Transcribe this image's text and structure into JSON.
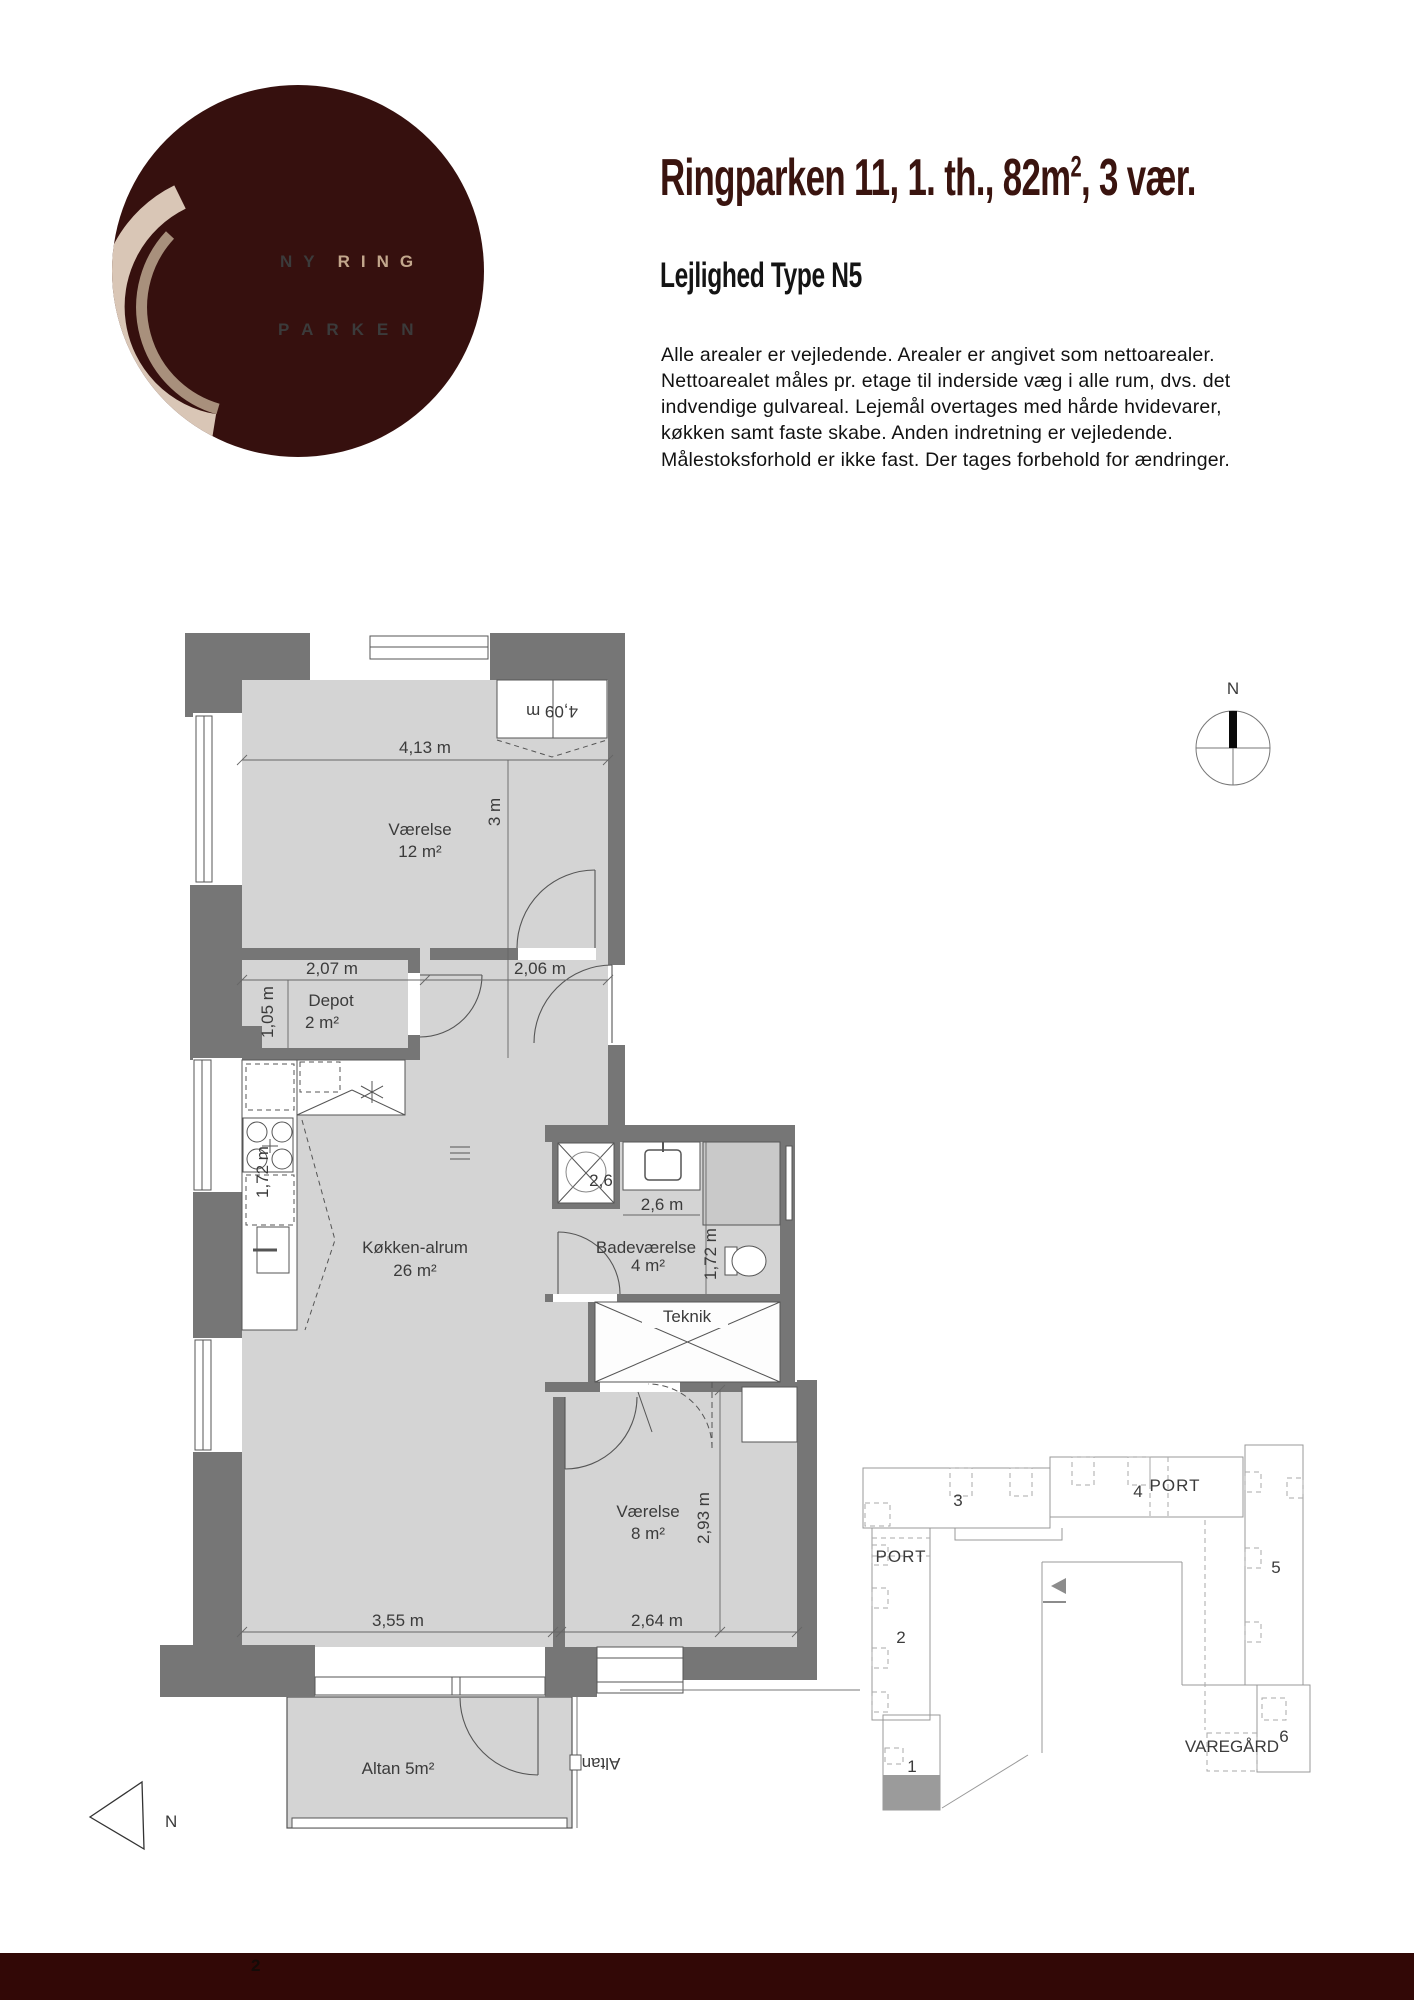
{
  "logo": {
    "line1_word1": "NY",
    "line1_word2": "RING",
    "line2": "PARKEN",
    "bg_color": "#36100e",
    "ring_color": "#d9c6b6",
    "ring_accent_color": "#a8907c",
    "accent_text_color": "#c3a78c"
  },
  "header": {
    "title_prefix": "Ringparken 11, 1. th., 82m",
    "title_sup": "2",
    "title_suffix": ", 3 vær.",
    "subtitle": "Lejlighed Type N5",
    "title_color": "#3a140f"
  },
  "description": "Alle arealer er vejledende. Arealer er angivet som nettoarealer. Nettoarealet måles pr. etage til inderside væg i alle rum, dvs. det indvendige gulvareal. Lejemål overtages med hårde hvidevarer, køkken samt faste skabe. Anden indretning er vejledende. Målestoksforhold er ikke fast. Der tages forbehold for ændringer.",
  "compass": {
    "north_label": "N"
  },
  "plan": {
    "colors": {
      "wall": "#767676",
      "floor": "#d4d4d4",
      "line": "#555555"
    },
    "rooms": {
      "vaerelse12": {
        "name": "Værelse",
        "area": "12 m²"
      },
      "depot": {
        "name": "Depot",
        "area": "2 m²"
      },
      "koekken": {
        "name": "Køkken-alrum",
        "area": "26 m²"
      },
      "bad": {
        "name": "Badeværelse",
        "area": "4 m²"
      },
      "teknik": {
        "name": "Teknik"
      },
      "vaerelse8": {
        "name": "Værelse",
        "area": "8 m²"
      },
      "altan": {
        "label": "Altan 5m²"
      },
      "neighbor_altan": {
        "label": "Altan"
      }
    },
    "dims": {
      "top_width": "4,13 m",
      "room1_height": "3 m",
      "closet": "4,09 m",
      "depot_width": "2,07 m",
      "hall_width": "2,06 m",
      "depot_height": "1,05 m",
      "kitchen_run": "1,72 m",
      "shower": "2,6",
      "bad_width": "2,6 m",
      "bad_height": "1,72 m",
      "living_width": "3,55 m",
      "room2_width": "2,64 m",
      "room2_height": "2,93 m"
    },
    "north_label": "N"
  },
  "siteplan": {
    "building_1": "1",
    "building_2": "2",
    "building_3": "3",
    "building_4": "4",
    "building_5": "5",
    "building_6": "6",
    "port_label": "PORT",
    "varegard_label": "VAREGÅRD"
  },
  "footer": {
    "page_number": "2",
    "bg_color": "#320806"
  }
}
